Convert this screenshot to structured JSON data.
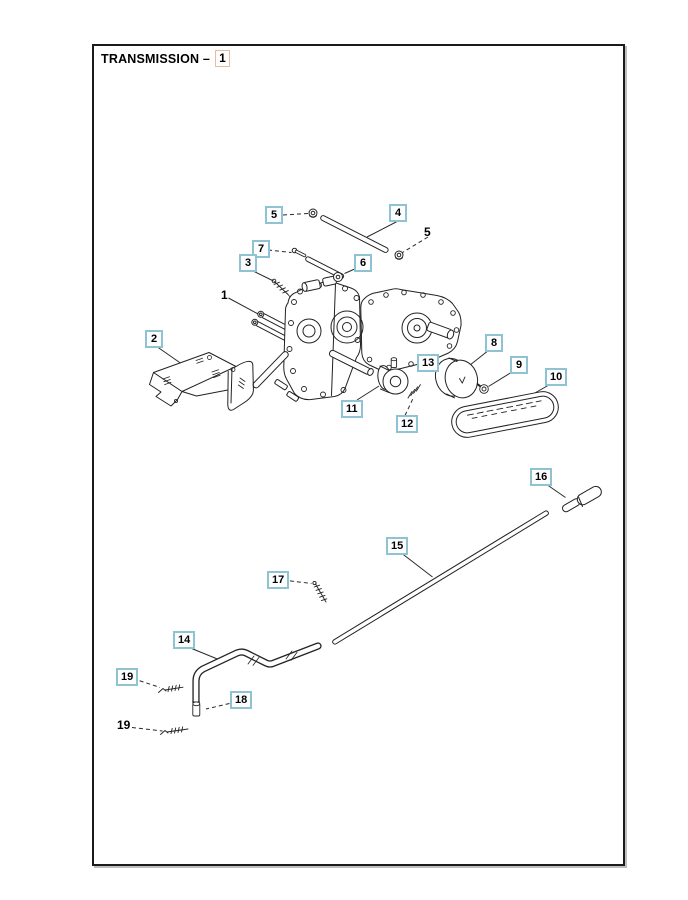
{
  "title": {
    "text": "TRANSMISSION –",
    "figure_number": "1"
  },
  "colors": {
    "callout_border": "#8fc3d2",
    "figure_box_border": "#e8bc9f",
    "line_color": "#222222",
    "page_background": "#ffffff"
  },
  "callouts": [
    {
      "label": "5",
      "boxed": true
    },
    {
      "label": "4",
      "boxed": true
    },
    {
      "label": "5",
      "boxed": false
    },
    {
      "label": "7",
      "boxed": true
    },
    {
      "label": "3",
      "boxed": true
    },
    {
      "label": "6",
      "boxed": true
    },
    {
      "label": "1",
      "boxed": false
    },
    {
      "label": "2",
      "boxed": true
    },
    {
      "label": "13",
      "boxed": true
    },
    {
      "label": "8",
      "boxed": true
    },
    {
      "label": "9",
      "boxed": true
    },
    {
      "label": "10",
      "boxed": true
    },
    {
      "label": "11",
      "boxed": true
    },
    {
      "label": "12",
      "boxed": true
    },
    {
      "label": "16",
      "boxed": true
    },
    {
      "label": "15",
      "boxed": true
    },
    {
      "label": "17",
      "boxed": true
    },
    {
      "label": "14",
      "boxed": true
    },
    {
      "label": "19",
      "boxed": true
    },
    {
      "label": "18",
      "boxed": true
    },
    {
      "label": "19",
      "boxed": false
    }
  ]
}
